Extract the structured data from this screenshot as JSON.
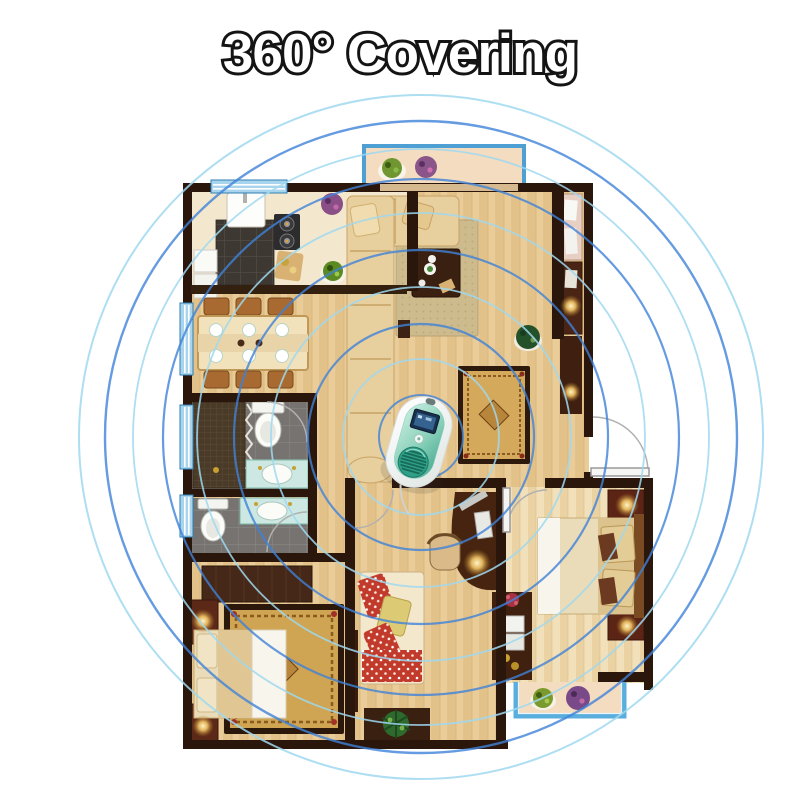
{
  "title": "360° Covering",
  "coverage": {
    "center": {
      "x": 421,
      "y": 437
    },
    "colors": {
      "light": "#9fd8f0",
      "dark": "#3f82d8"
    },
    "ripples": [
      {
        "r": 42,
        "tone": "dark",
        "width": 2.0
      },
      {
        "r": 78,
        "tone": "light",
        "width": 1.8
      },
      {
        "r": 113,
        "tone": "dark",
        "width": 2.2
      },
      {
        "r": 150,
        "tone": "light",
        "width": 1.8
      },
      {
        "r": 187,
        "tone": "dark",
        "width": 2.2
      },
      {
        "r": 224,
        "tone": "light",
        "width": 1.8
      },
      {
        "r": 258,
        "tone": "dark",
        "width": 2.2
      },
      {
        "r": 288,
        "tone": "light",
        "width": 1.8
      },
      {
        "r": 316,
        "tone": "dark",
        "width": 2.4
      },
      {
        "r": 342,
        "tone": "light",
        "width": 2.0
      }
    ]
  },
  "device": {
    "colors": {
      "body": "#f2f7f5",
      "panel": "#57b49c",
      "screen": "#18304e",
      "speaker": "#2f9f88"
    }
  },
  "palette": {
    "background": "#ffffff",
    "walls": "#2b160c",
    "wood_floor": "#e9cc98",
    "wood_floor_light": "#f2e0ba",
    "kitchen_tile": "#3e3833",
    "bath_tile": "#73706b",
    "counter": "#f3e8ce",
    "window_blue": "#4e9fd4",
    "balcony_floor": "#f4dcc0",
    "sofa": "#e8cf9e",
    "rug_gold": "#d4a95c",
    "furniture_dark": "#46240f",
    "lamp_glow": "#ffd98a",
    "title_fill": "#ffffff",
    "title_outline": "#141414"
  }
}
